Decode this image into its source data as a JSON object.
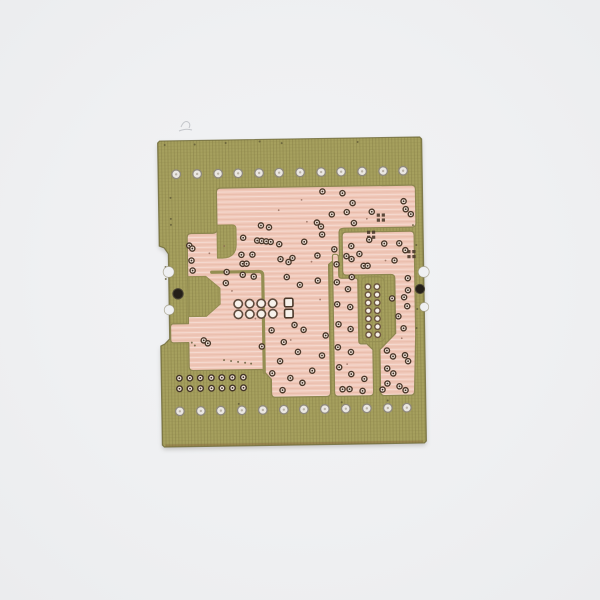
{
  "scene": {
    "description": "Photograph of a bare printed circuit board (solder side) with salmon-pink copper pours on an olive-green fiberglass substrate, centered on a plain light-gray background",
    "colors": {
      "bg": "#eff0f2",
      "board": "#a6a05e",
      "boardEdge": "#6f6a3a",
      "boardBottomEdge": "#8a7040",
      "copper": "#f0c8b9",
      "copperEdge": "#8d8750",
      "gap": "#948e52",
      "cutout": "#a19b5c",
      "ringDark": "#4a382a",
      "holeCenter": "#3a2d22",
      "holePale": "#efe2d8",
      "padWhite": "#f6f1ea",
      "rowHoleFill": "#eae7e2",
      "rowHoleRing": "#8f897d",
      "black": "#241f19",
      "speckOlive": "#5f5936",
      "speckCopper": "#8a6252",
      "scratch": "#b9bcc0"
    }
  },
  "board": {
    "rotation": -0.9,
    "cx": 292,
    "cy": 292,
    "outline": "M 162,139 L 422,139 L 424,141 L 424,443 L 422,445 L 162,445 L 160,443 L 160,344 L 164,342 L 169,337 L 169,252 L 165,246 L 160,244 L 160,141 Z",
    "bottom_edge_line": "M 163,443.5 L 421,443.5",
    "edge_bites": [
      [
        169,
        270,
        5.5
      ],
      [
        169,
        308,
        5.0
      ],
      [
        424,
        274,
        5.5
      ],
      [
        424,
        309,
        4.5
      ]
    ],
    "black_holes": [
      [
        178,
        292,
        5.2
      ],
      [
        420,
        291,
        4.6
      ]
    ]
  },
  "pours": [
    {
      "name": "copper-pour-main",
      "d": "M 222,187 L 413,187 Q 417,187 417,191 L 417,225 Q 417,229 413,229 L 345,229 Q 340,229 340,233 L 340,256 L 329,265 L 329,393 Q 329,397 325,397 L 274,397 Q 270,397 270,393 L 270,379 L 261,369 L 192,369 Q 188,369 188,365 L 188,341 L 173,341 Q 170,341 170,338 L 170,325 Q 170,322 173,322 L 188,322 L 188,236 Q 188,232 192,232 L 214,232 Q 218,232 218,228 L 218,191 Q 218,187 222,187 Z"
    },
    {
      "name": "copper-pour-top-right",
      "d": "M 347,233 L 411,233 Q 415,233 415,237 L 415,337 L 413,393 Q 413,397 409,397 L 383,397 Q 379,397 379,393 L 379,351 L 395,335 L 395,280 Q 395,276 391,276 L 347,276 Q 343,276 343,272 L 343,237 Q 343,233 347,233 Z"
    },
    {
      "name": "copper-pour-bottom-center",
      "d": "M 335,255 L 336,255 Q 339,255 339,258 L 339,276 Q 339,279 342,279 L 355,279 Q 358,279 358,282 L 358,342 Q 358,345 361,345 L 366,345 L 372,351 L 372,393 Q 372,397 368,397 L 337,397 Q 333,397 333,393 L 333,257 Q 333,255 335,255 Z"
    }
  ],
  "cutouts": [
    {
      "name": "pour-step-notch",
      "d": "M 218,224 L 233,224 Q 237,224 237,228 L 237,243 Q 237,257 223,257 L 218,257 Z"
    },
    {
      "name": "pour-left-notch",
      "d": "M 188,275 L 206,275 L 220,287 L 220,303 L 206,315 L 188,315 Z"
    },
    {
      "name": "pad-slot",
      "d": "M 368,278 L 378,278 Q 384.5,278 384.5,284.5 L 384.5,336.5 Q 384.5,343 378,343 L 368,343 Q 361.5,343 361.5,336.5 L 361.5,284.5 Q 361.5,278 368,278 Z"
    }
  ],
  "gaps": [
    {
      "name": "inner-gap-channel",
      "d": "M 212,271 L 259,271 Q 263,271 263,275 L 263,372"
    }
  ],
  "holes": {
    "top_row": {
      "y": 172.5,
      "r": 4.3,
      "xs": [
        178,
        199,
        220,
        240,
        261,
        281,
        302,
        323,
        343,
        364,
        385,
        405
      ]
    },
    "bottom_row": {
      "y": 409.5,
      "r": 4.3,
      "xs": [
        178,
        199,
        219,
        240,
        261,
        282,
        302,
        323,
        344,
        365,
        386,
        405
      ]
    },
    "double_rows": {
      "ys": [
        376.5,
        387
      ],
      "r": 2.8,
      "xs": [
        178,
        188.5,
        199,
        210,
        220.5,
        231,
        242
      ]
    },
    "cluster_round": {
      "ys": [
        303,
        313.5
      ],
      "r": 4.2,
      "xs": [
        238,
        249.5,
        261,
        272.5
      ]
    },
    "cluster_square": {
      "ys": [
        302.5,
        313.5
      ],
      "size": 8.5,
      "xs": [
        288.5
      ]
    },
    "pad_slot_holes": {
      "ys": [
        288,
        296,
        304,
        312,
        320,
        328,
        336
      ],
      "r": 2.8,
      "xs": [
        368,
        377
      ]
    },
    "square_clusters": [
      [
        382,
        219
      ],
      [
        372,
        236
      ],
      [
        412,
        256
      ]
    ],
    "small": [
      [
        324,
        192
      ],
      [
        344,
        194
      ],
      [
        354,
        204
      ],
      [
        348,
        213
      ],
      [
        373,
        213
      ],
      [
        355,
        224
      ],
      [
        322,
        227
      ],
      [
        318,
        223
      ],
      [
        333,
        215
      ],
      [
        405,
        203
      ],
      [
        407,
        211
      ],
      [
        412,
        216
      ],
      [
        262,
        225
      ],
      [
        270,
        227
      ],
      [
        305,
        242
      ],
      [
        244,
        237
      ],
      [
        258,
        240
      ],
      [
        262.5,
        240.5
      ],
      [
        267,
        241
      ],
      [
        271.5,
        241.5
      ],
      [
        280,
        244
      ],
      [
        293,
        258
      ],
      [
        318,
        256
      ],
      [
        281,
        259
      ],
      [
        289,
        262
      ],
      [
        243,
        263
      ],
      [
        243,
        274
      ],
      [
        254,
        276
      ],
      [
        287,
        277
      ],
      [
        300,
        285
      ],
      [
        318,
        281
      ],
      [
        323,
        235
      ],
      [
        335,
        250
      ],
      [
        294,
        325
      ],
      [
        271,
        330
      ],
      [
        303,
        330
      ],
      [
        283,
        342
      ],
      [
        261,
        346
      ],
      [
        297,
        352
      ],
      [
        279,
        361
      ],
      [
        271,
        373
      ],
      [
        289,
        378
      ],
      [
        301,
        383
      ],
      [
        281,
        390
      ],
      [
        311,
        371
      ],
      [
        321,
        356
      ],
      [
        325,
        336
      ],
      [
        190,
        244
      ],
      [
        193,
        247
      ],
      [
        192,
        259
      ],
      [
        193,
        269
      ],
      [
        227,
        271
      ],
      [
        226,
        282
      ],
      [
        242,
        254
      ],
      [
        253,
        254
      ],
      [
        247,
        263
      ],
      [
        203,
        339
      ],
      [
        207,
        342
      ],
      [
        352,
        247
      ],
      [
        360,
        255
      ],
      [
        352,
        260
      ],
      [
        370,
        241
      ],
      [
        385,
        245
      ],
      [
        400,
        245
      ],
      [
        406,
        252
      ],
      [
        395,
        262
      ],
      [
        364,
        267
      ],
      [
        368,
        267
      ],
      [
        347,
        257
      ],
      [
        408,
        280
      ],
      [
        408,
        292
      ],
      [
        404,
        299
      ],
      [
        392,
        300
      ],
      [
        407,
        308
      ],
      [
        398,
        318
      ],
      [
        403,
        330
      ],
      [
        386,
        352
      ],
      [
        392,
        358
      ],
      [
        404,
        357
      ],
      [
        407,
        363
      ],
      [
        386,
        370
      ],
      [
        392,
        375
      ],
      [
        386,
        385
      ],
      [
        398,
        388
      ],
      [
        404,
        392
      ],
      [
        381,
        391
      ],
      [
        337,
        265
      ],
      [
        352,
        278
      ],
      [
        337,
        283
      ],
      [
        348,
        290
      ],
      [
        337,
        305
      ],
      [
        350,
        308
      ],
      [
        338,
        325
      ],
      [
        350,
        330
      ],
      [
        337,
        348
      ],
      [
        350,
        353
      ],
      [
        338,
        368
      ],
      [
        350,
        375
      ],
      [
        363,
        380
      ],
      [
        348,
        390
      ],
      [
        361,
        392
      ],
      [
        341,
        390
      ]
    ],
    "specks_olive": [
      [
        167,
        143
      ],
      [
        197,
        143
      ],
      [
        228,
        142
      ],
      [
        262,
        141
      ],
      [
        284,
        143
      ],
      [
        360,
        143
      ],
      [
        172,
        196
      ],
      [
        172,
        217
      ],
      [
        172,
        223
      ],
      [
        166,
        265
      ],
      [
        166,
        277
      ],
      [
        414,
        227
      ],
      [
        417,
        247
      ],
      [
        417,
        311
      ],
      [
        416,
        330
      ],
      [
        237,
        403
      ],
      [
        340,
        403
      ],
      [
        386,
        402
      ],
      [
        191,
        341
      ],
      [
        194,
        344
      ],
      [
        223,
        359
      ],
      [
        230,
        360
      ],
      [
        237,
        361
      ],
      [
        244,
        362
      ],
      [
        250,
        363
      ]
    ],
    "specks_copper": [
      [
        303,
        200
      ],
      [
        280,
        210
      ],
      [
        312,
        262
      ],
      [
        252,
        300
      ],
      [
        320,
        300
      ],
      [
        290,
        340
      ],
      [
        225,
        245
      ],
      [
        210,
        252
      ],
      [
        346,
        365
      ],
      [
        401,
        340
      ],
      [
        386,
        262
      ],
      [
        232,
        290
      ],
      [
        255,
        318
      ],
      [
        308,
        222
      ],
      [
        368,
        220
      ]
    ]
  },
  "marks": {
    "scratch": "M 181,127 q 3,-7 7,-5 q 3,2 1,6 M 179,131 q 7,-3 13,-1"
  }
}
